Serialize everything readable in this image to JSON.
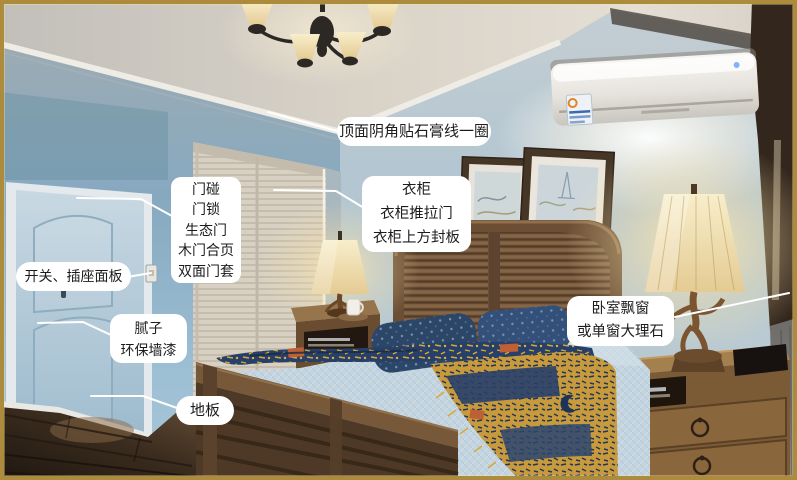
{
  "annotations": {
    "style": {
      "label_bg": "#ffffff",
      "label_text_color": "#1c1c1c",
      "leader_line_color": "#ffffff",
      "frame_border_color": "#ac8c3c"
    },
    "items": [
      {
        "id": "ceiling-molding",
        "lines": [
          "顶面阴角贴石膏线一圈"
        ]
      },
      {
        "id": "door-hardware",
        "lines": [
          "门碰",
          "门锁",
          "生态门",
          "木门合页",
          "双面门套"
        ]
      },
      {
        "id": "switch-socket",
        "lines": [
          "开关、插座面板"
        ]
      },
      {
        "id": "putty-paint",
        "lines": [
          "腻子",
          "环保墙漆"
        ]
      },
      {
        "id": "floor",
        "lines": [
          "地板"
        ]
      },
      {
        "id": "wardrobe",
        "lines": [
          "衣柜",
          "衣柜推拉门",
          "衣柜上方封板"
        ]
      },
      {
        "id": "bay-window",
        "lines": [
          "卧室飘窗",
          "或单窗大理石"
        ]
      }
    ]
  },
  "photo_palette": {
    "wall_blue": "#a9c3d3",
    "ceiling": "#d6d0c6",
    "wood_dark": "#4e3926",
    "wood_mid": "#7b5a3b",
    "lamp_glow": "#f2e2ae",
    "bedding_blue": "#c6d7e1",
    "blanket_navy": "#27406a",
    "blanket_gold": "#d9a832",
    "floor_brown": "#3a2c1e"
  }
}
